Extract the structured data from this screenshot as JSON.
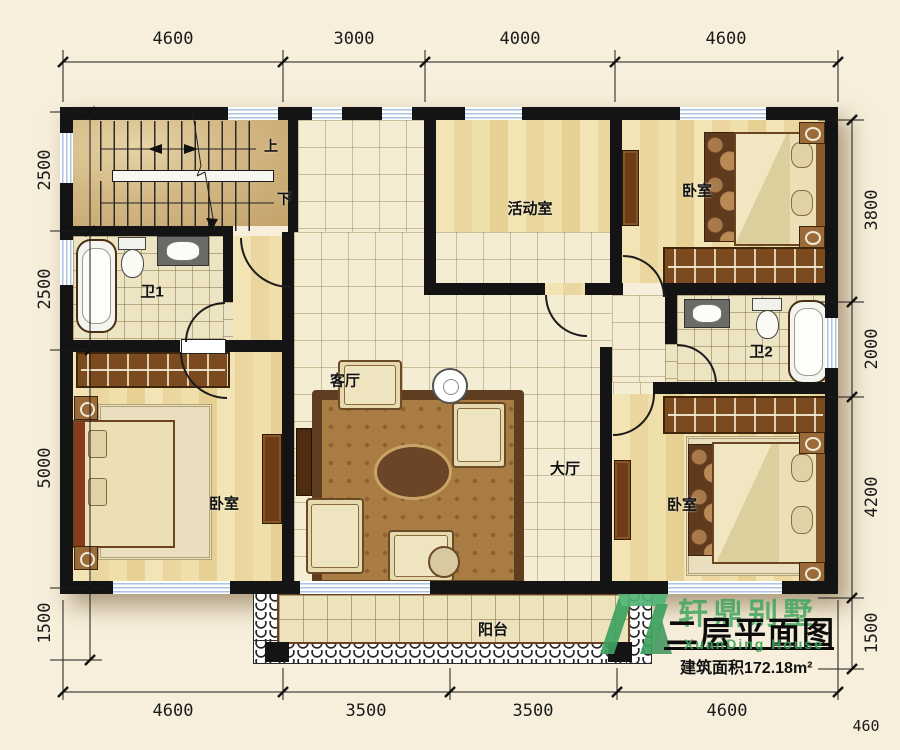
{
  "plan": {
    "rooms": {
      "activity": "活动室",
      "bedroom_tr": "卧室",
      "bedroom_bl": "卧室",
      "bedroom_br": "卧室",
      "bath1": "卫1",
      "bath2": "卫2",
      "living": "客厅",
      "hall": "大厅",
      "balcony": "阳台"
    },
    "stairs": {
      "up": "上",
      "down": "下"
    }
  },
  "dims": {
    "top": [
      "4600",
      "3000",
      "4000",
      "4600"
    ],
    "bottom": [
      "4600",
      "3500",
      "3500",
      "4600"
    ],
    "left": [
      "2500",
      "2500",
      "5000",
      "1500"
    ],
    "right": [
      "3800",
      "2000",
      "4200",
      "1500"
    ],
    "corner": "460"
  },
  "titleblock": {
    "brand": "轩鼎别墅",
    "brand_en": "XuanDing House",
    "title": "二层平面图",
    "area": "建筑面积172.18m²"
  },
  "colors": {
    "wall": "#141414",
    "background": "#f7efdb",
    "brand_green": "#3da25f"
  }
}
